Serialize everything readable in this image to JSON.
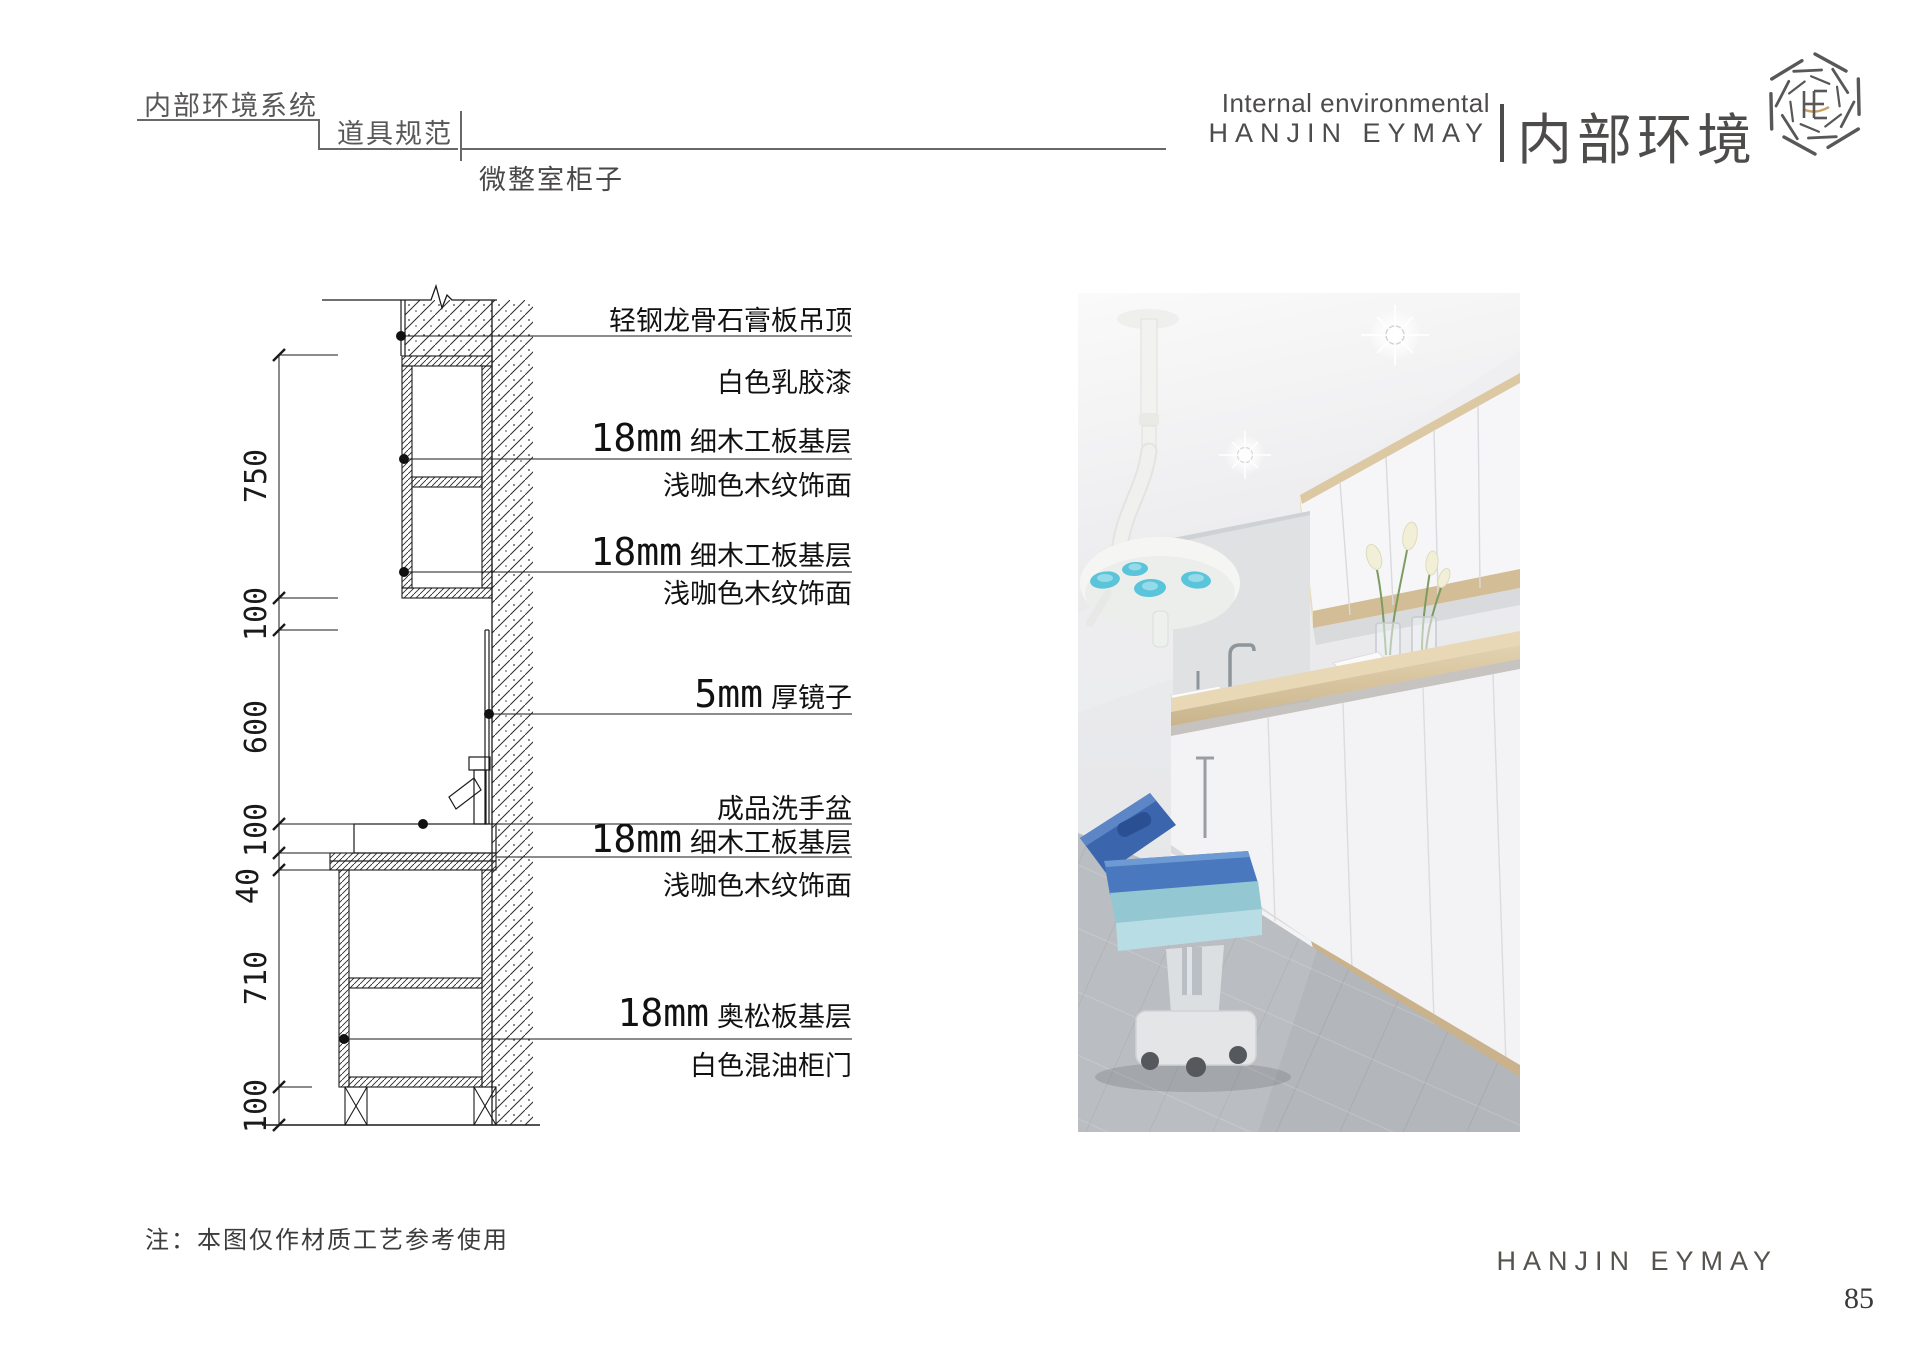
{
  "header": {
    "breadcrumb_level1": "内部环境系统",
    "breadcrumb_level2": "道具规范",
    "breadcrumb_level3": "微整室柜子",
    "right_en_line1": "Internal environmental",
    "right_en_line2": "HANJIN EYMAY",
    "right_cn": "内部环境"
  },
  "drawing": {
    "dimensions": [
      "750",
      "100",
      "600",
      "100",
      "40",
      "710",
      "100"
    ],
    "annotations": [
      {
        "prefix": "",
        "text": "轻钢龙骨石膏板吊顶"
      },
      {
        "prefix": "",
        "text": "白色乳胶漆"
      },
      {
        "prefix": "18mm",
        "text": "细木工板基层"
      },
      {
        "prefix": "",
        "text": "浅咖色木纹饰面"
      },
      {
        "prefix": "18mm",
        "text": "细木工板基层"
      },
      {
        "prefix": "",
        "text": "浅咖色木纹饰面"
      },
      {
        "prefix": "5mm",
        "text": "厚镜子"
      },
      {
        "prefix": "",
        "text": "成品洗手盆"
      },
      {
        "prefix": "18mm",
        "text": "细木工板基层"
      },
      {
        "prefix": "",
        "text": "浅咖色木纹饰面"
      },
      {
        "prefix": "18mm",
        "text": "奥松板基层"
      },
      {
        "prefix": "",
        "text": "白色混油柜门"
      }
    ]
  },
  "footer": {
    "note": "注：本图仅作材质工艺参考使用",
    "brand": "HANJIN EYMAY",
    "page_number": "85"
  },
  "colors": {
    "header_gray": "#595757",
    "line_dark": "#1a1a1a",
    "logo_gold": "#c9a063",
    "wood": "#d8c5a1",
    "bed_blue": "#4a78bf",
    "bed_teal": "#93c7d2",
    "carpet_gray": "#b4b8bc"
  }
}
